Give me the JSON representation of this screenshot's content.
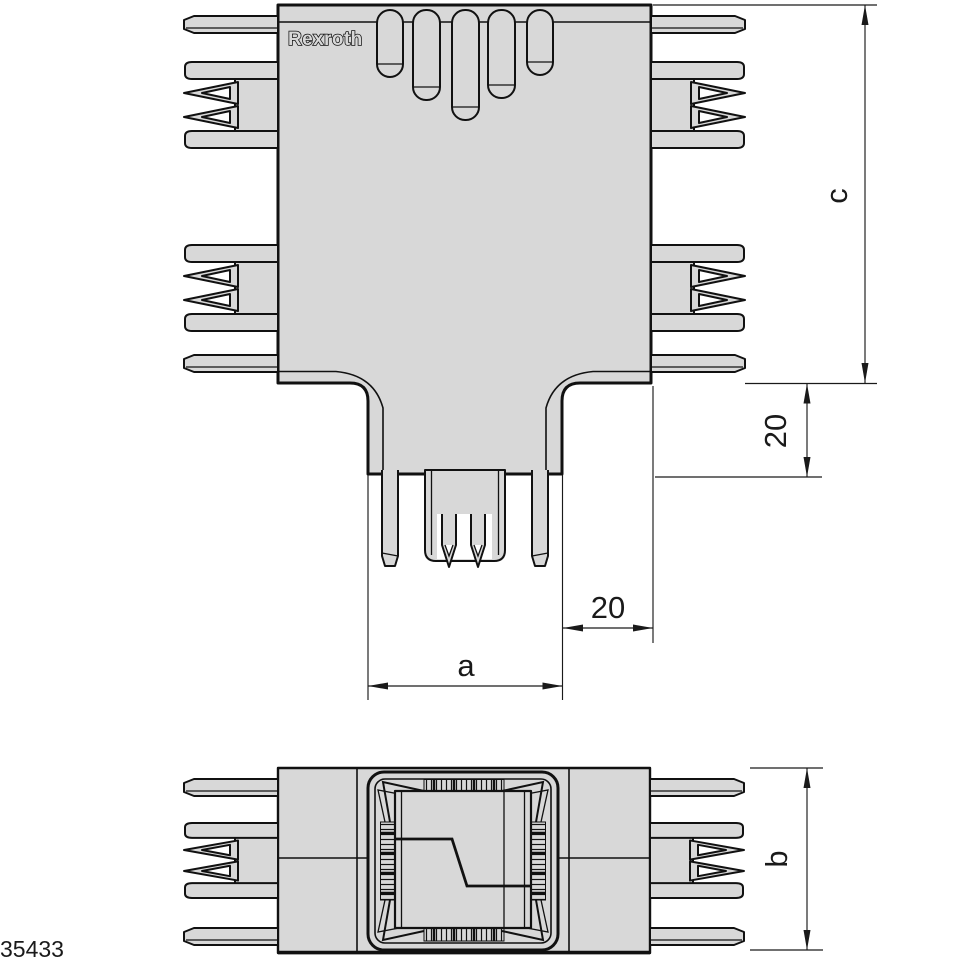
{
  "figure": {
    "number": "35433"
  },
  "brand": {
    "logo_text": "Rexroth"
  },
  "dimensions": {
    "a": {
      "label": "a"
    },
    "b": {
      "label": "b"
    },
    "c": {
      "label": "c"
    },
    "offset_vertical": {
      "label": "20"
    },
    "offset_horizontal": {
      "label": "20"
    }
  },
  "colors": {
    "background": "#ffffff",
    "part_fill": "#d8d8d8",
    "outline": "#111111",
    "dimension": "#1a1a1a"
  }
}
